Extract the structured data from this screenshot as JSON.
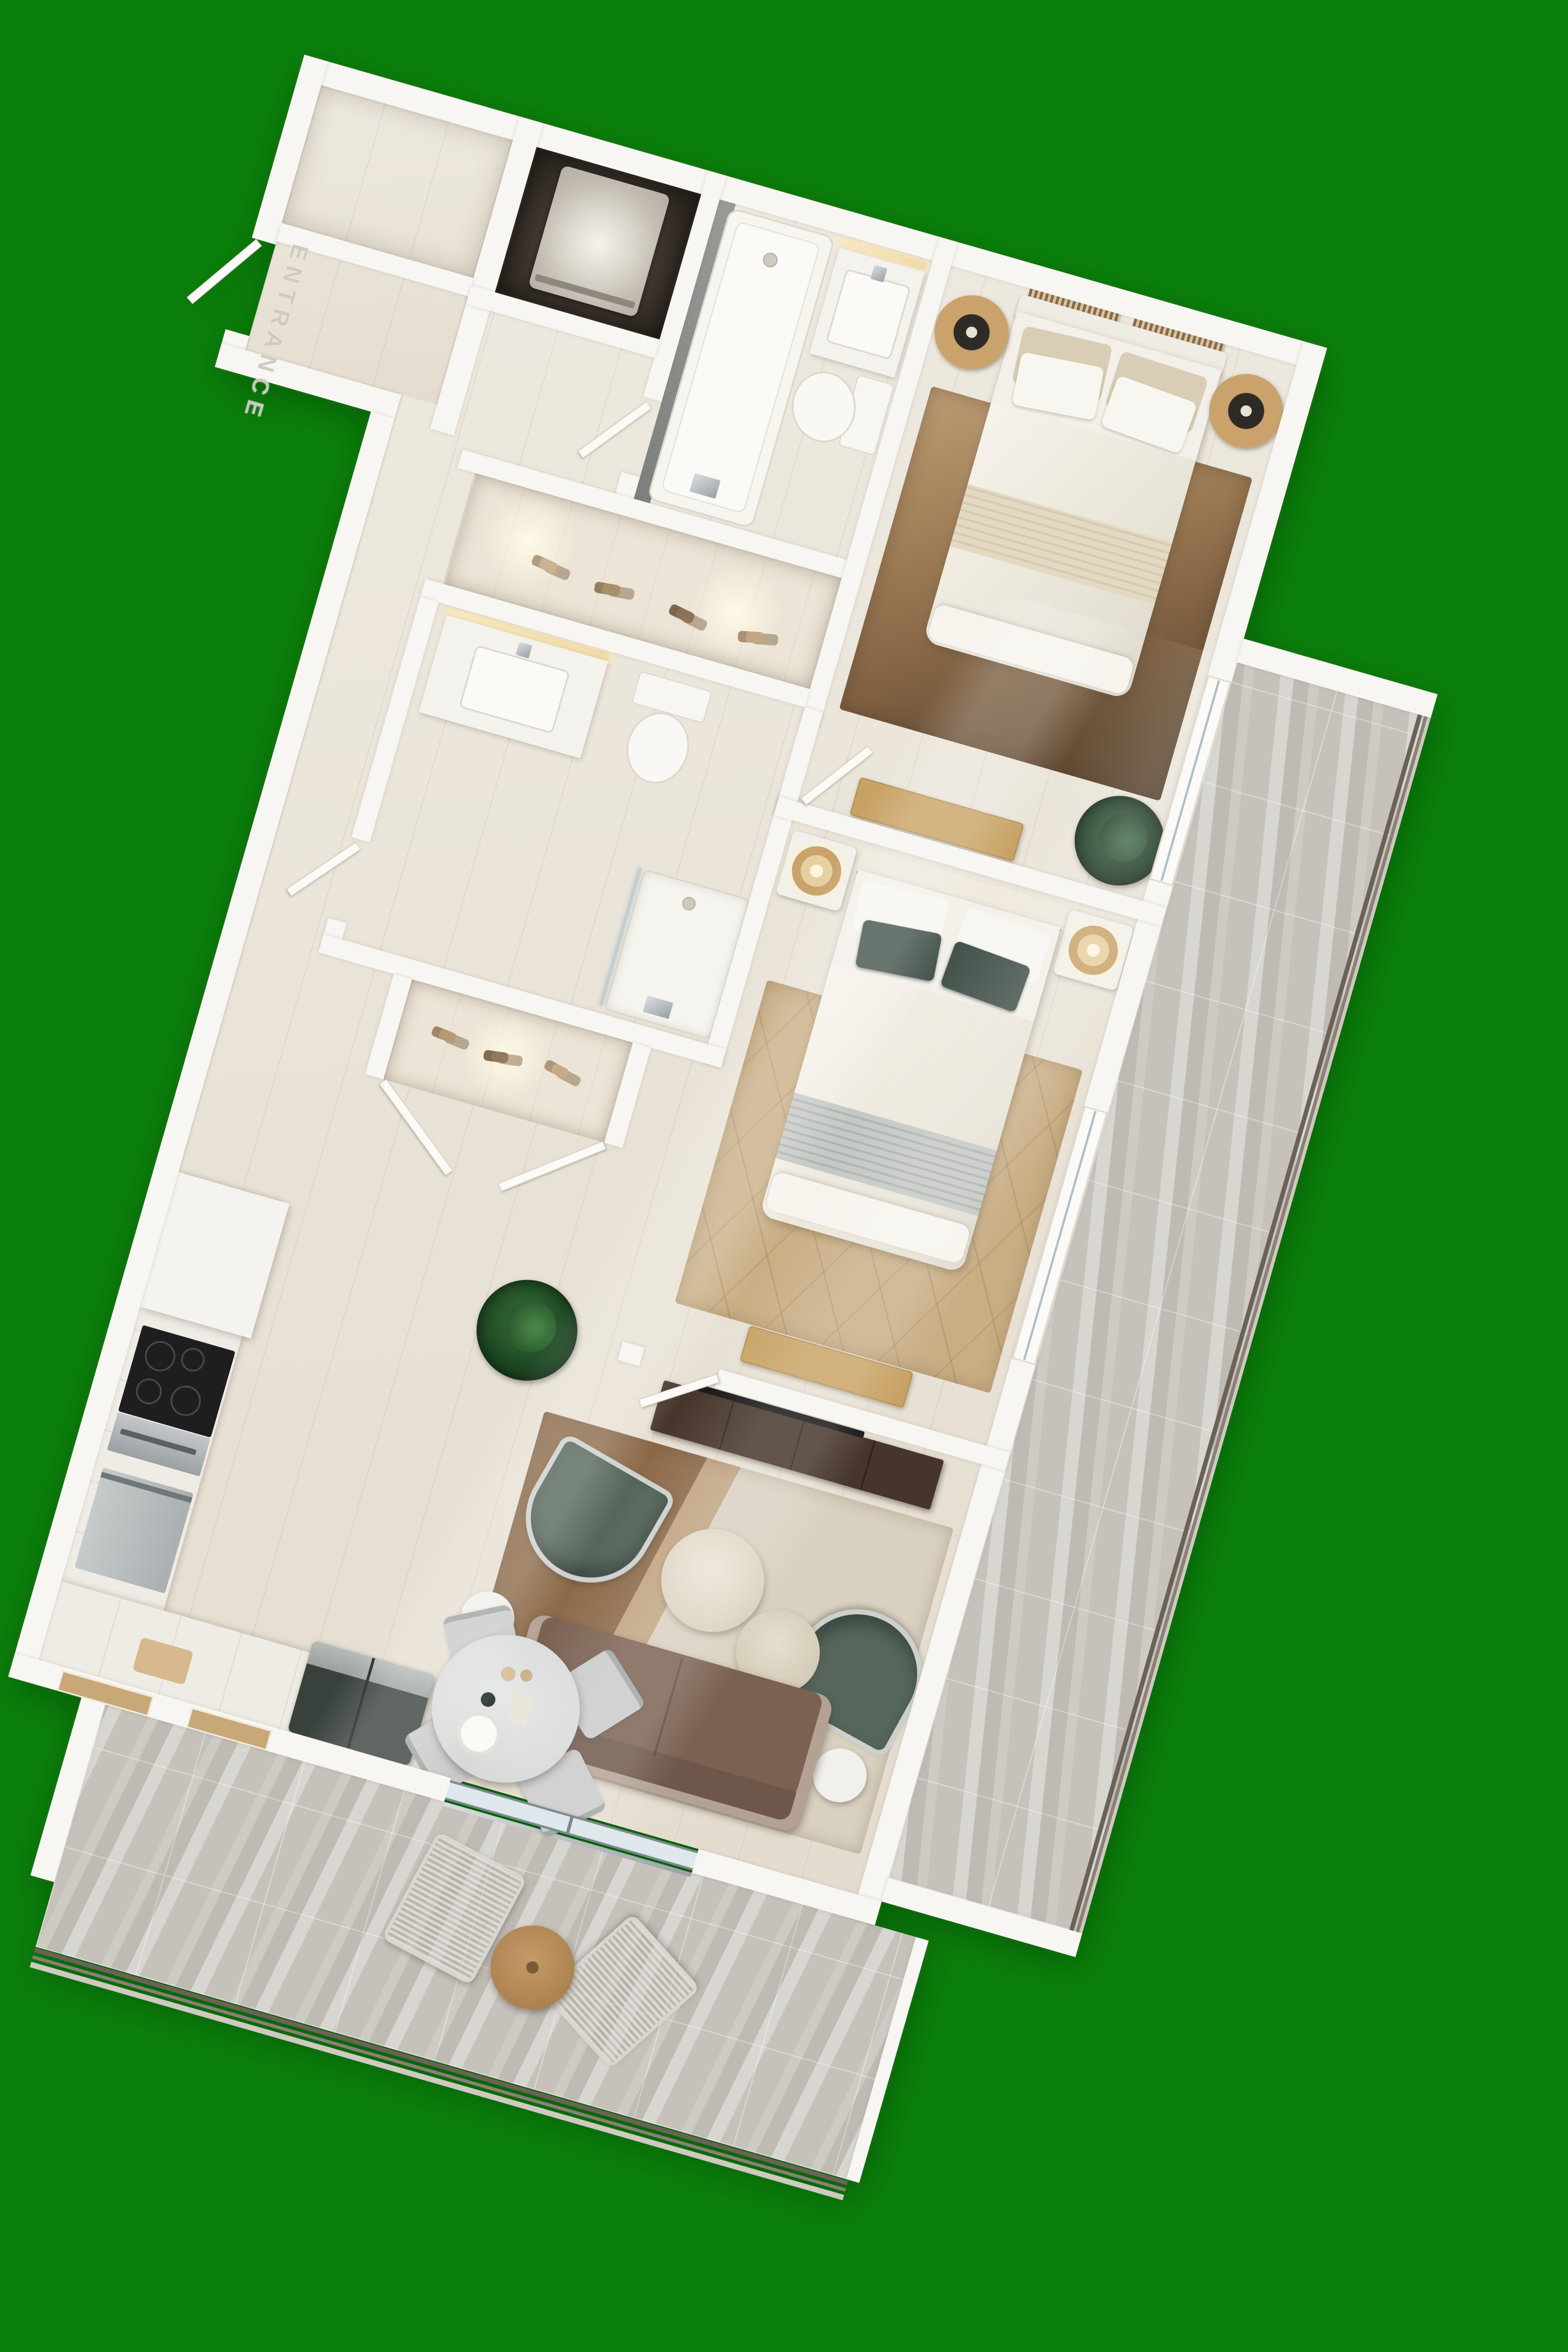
{
  "page": {
    "title": "3D Apartment Floor Plan Render",
    "background": "#0a800a"
  },
  "plan": {
    "view": "top-down 3d render",
    "rotation_deg": 16,
    "entrance_label": "ENTRANCE",
    "rooms": [
      {
        "name": "entry-vestibule"
      },
      {
        "name": "storage-closet"
      },
      {
        "name": "utility-closet-washer"
      },
      {
        "name": "bathroom-1"
      },
      {
        "name": "bedroom-1"
      },
      {
        "name": "hallway"
      },
      {
        "name": "linen-closet"
      },
      {
        "name": "bathroom-2"
      },
      {
        "name": "shoe-closet"
      },
      {
        "name": "bedroom-2"
      },
      {
        "name": "kitchen"
      },
      {
        "name": "living-room"
      },
      {
        "name": "dining-area"
      },
      {
        "name": "side-balcony"
      },
      {
        "name": "lower-balcony"
      }
    ]
  },
  "colors": {
    "green_bg": "#0a800a",
    "wall": "#f8f6f2",
    "wood_floor": "#e9e3d7",
    "tile_floor": "#c6c2bb",
    "rug_bed2": "#c9ae85",
    "rug_living_brown": "#8c6a49",
    "rug_living_cream": "#d9d1c0",
    "sofa_brown": "#7b6152",
    "chair_green": "#56665b",
    "wood_furniture": "#c8a264",
    "dark_console": "#46352a",
    "appliance_dark": "#39413c",
    "linen_white": "#f3f0e9",
    "pillow_green": "#42524a",
    "lamp_gold": "#c9a36a",
    "glass": "#dfe8ec",
    "railing": "#6b6257"
  }
}
